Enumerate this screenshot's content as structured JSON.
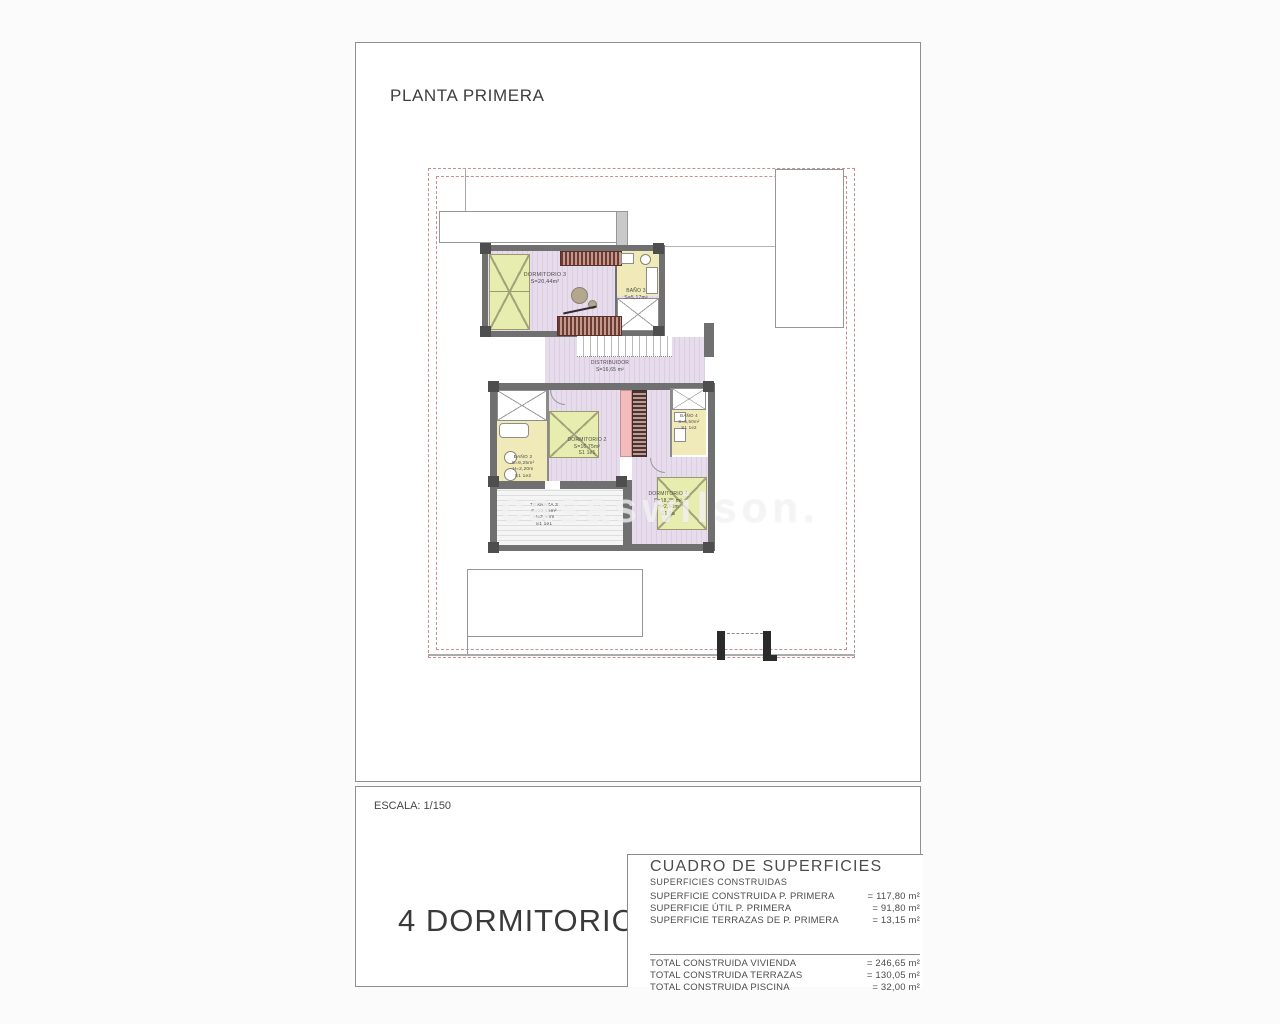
{
  "page": {
    "title": "PLANTA PRIMERA",
    "scale_label": "ESCALA: 1/150",
    "bedrooms_label": "4 DORMITORIOS",
    "watermark": "casaswilson."
  },
  "plan": {
    "rooms": [
      {
        "id": "dormitorio-3",
        "lines": [
          "DORMITORIO 3",
          "S=20,44m²"
        ]
      },
      {
        "id": "bano-3",
        "lines": [
          "BAÑO 3",
          "S=5,17m²"
        ]
      },
      {
        "id": "distribuidor",
        "lines": [
          "DISTRIBUIDOR",
          "S=16,65 m²"
        ]
      },
      {
        "id": "dormitorio-2",
        "lines": [
          "DORMITORIO 2",
          "S=16,75m²",
          "S1 1e1"
        ]
      },
      {
        "id": "bano-2",
        "lines": [
          "BAÑO 2",
          "S=9,25m²",
          "H=2,20m",
          "S1 1e2"
        ]
      },
      {
        "id": "bano-4",
        "lines": [
          "BAÑO 4",
          "S=5,50m²",
          "S1 1e2"
        ]
      },
      {
        "id": "dormitorio-4",
        "lines": [
          "DORMITORIO 4",
          "S=18,35 m²",
          "H=2,60m",
          "S1 1a"
        ]
      },
      {
        "id": "terraza-3",
        "lines": [
          "TERRAZA 3",
          "S=13,15m²",
          "H=2,60m",
          "S1 1e1"
        ]
      }
    ]
  },
  "surfaces_table": {
    "title": "CUADRO DE SUPERFICIES",
    "subtitle": "SUPERFICIES CONSTRUIDAS",
    "rows": [
      {
        "label": "SUPERFICIE CONSTRUIDA P. PRIMERA",
        "value": "= 117,80 m²"
      },
      {
        "label": "SUPERFICIE ÚTIL P. PRIMERA",
        "value": "= 91,80 m²"
      },
      {
        "label": "SUPERFICIE TERRAZAS DE P. PRIMERA",
        "value": "= 13,15 m²"
      }
    ],
    "totals": [
      {
        "label": "TOTAL CONSTRUIDA VIVIENDA",
        "value": "= 246,65 m²"
      },
      {
        "label": "TOTAL CONSTRUIDA TERRAZAS",
        "value": "= 130,05 m²"
      },
      {
        "label": "TOTAL CONSTRUIDA PISCINA",
        "value": "= 32,00 m²"
      }
    ]
  },
  "colors": {
    "wall": "#707070",
    "room_floor_lilac": "#e7dcec",
    "bath_floor_yellow": "#efeab8",
    "bed_green": "#e7edae",
    "wardrobe_maroon": "#6e3a34",
    "stair_pink": "#f2bcbc",
    "parcel_dashed": "#c98f8f",
    "sheet_border": "#8f8f8f"
  }
}
